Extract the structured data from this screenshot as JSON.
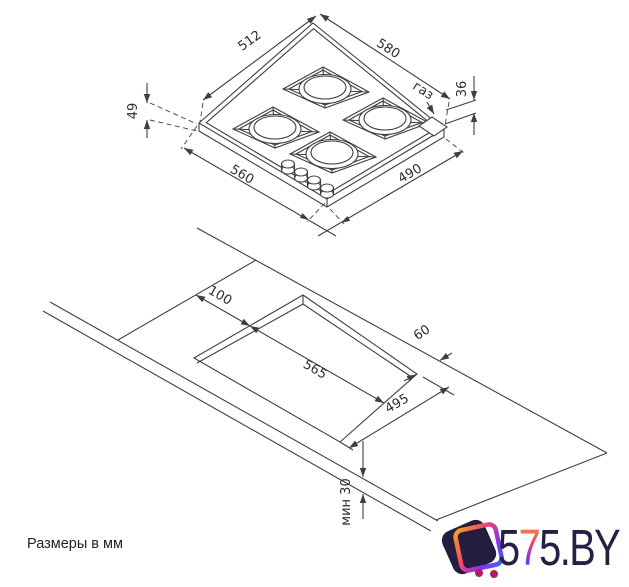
{
  "drawing": {
    "hob_view": {
      "dim_top_left": "512",
      "dim_top_right": "580",
      "gas_label": "газ",
      "dim_height_right": "36",
      "dim_height_left": "49",
      "dim_bottom_left": "560",
      "dim_bottom_right": "490"
    },
    "cutout_view": {
      "dim_offset": "100",
      "dim_length": "565",
      "dim_clearance": "60",
      "dim_width": "495",
      "dim_min": "мин 30"
    },
    "note": "Размеры в мм"
  },
  "watermark": {
    "digit_1": "5",
    "digit_2": "7",
    "digit_3": "5.BY"
  },
  "colors": {
    "line": "#3f3f3f",
    "text": "#2d2d2d",
    "logo_navy": "#272045",
    "logo_gradient": [
      "#f7a21e",
      "#f0426e",
      "#8a2ff0",
      "#2f6df0"
    ],
    "logo_dot": "#b01e5e"
  }
}
